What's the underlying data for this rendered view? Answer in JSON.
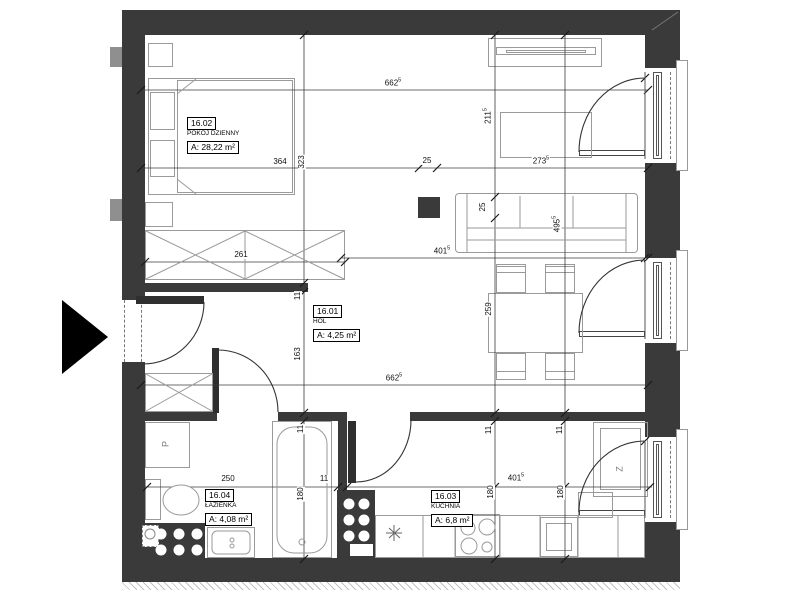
{
  "plan_title": "floor-plan",
  "rooms": [
    {
      "key": "living",
      "id": "16.02",
      "name": "POKÓJ DZIENNY",
      "area": "A: 28,22 m²",
      "x": 187,
      "y": 114
    },
    {
      "key": "hall",
      "id": "16.01",
      "name": "HOL",
      "area": "A: 4,25 m²",
      "x": 313,
      "y": 302
    },
    {
      "key": "bathroom",
      "id": "16.04",
      "name": "ŁAZIENKA",
      "area": "A: 4,08 m²",
      "x": 205,
      "y": 486
    },
    {
      "key": "kitchen",
      "id": "16.03",
      "name": "KUCHNIA",
      "area": "A: 6,8 m²",
      "x": 431,
      "y": 487
    }
  ],
  "dimensions": [
    {
      "v": "662",
      "sup": "5",
      "x": 393,
      "y": 83,
      "o": "h"
    },
    {
      "v": "364",
      "sup": "",
      "x": 280,
      "y": 162,
      "o": "h"
    },
    {
      "v": "25",
      "sup": "",
      "x": 427,
      "y": 161,
      "o": "h"
    },
    {
      "v": "273",
      "sup": "5",
      "x": 541,
      "y": 161,
      "o": "h"
    },
    {
      "v": "261",
      "sup": "",
      "x": 241,
      "y": 255,
      "o": "h"
    },
    {
      "v": "401",
      "sup": "5",
      "x": 442,
      "y": 251,
      "o": "h"
    },
    {
      "v": "662",
      "sup": "5",
      "x": 394,
      "y": 378,
      "o": "h"
    },
    {
      "v": "250",
      "sup": "",
      "x": 228,
      "y": 479,
      "o": "h"
    },
    {
      "v": "11",
      "sup": "",
      "x": 324,
      "y": 479,
      "o": "h"
    },
    {
      "v": "401",
      "sup": "5",
      "x": 516,
      "y": 478,
      "o": "h"
    },
    {
      "v": "323",
      "sup": "",
      "x": 302,
      "y": 162,
      "o": "v"
    },
    {
      "v": "211",
      "sup": "5",
      "x": 488,
      "y": 116,
      "o": "v"
    },
    {
      "v": "25",
      "sup": "",
      "x": 483,
      "y": 207,
      "o": "v"
    },
    {
      "v": "259",
      "sup": "",
      "x": 489,
      "y": 309,
      "o": "v"
    },
    {
      "v": "11",
      "sup": "",
      "x": 489,
      "y": 430,
      "o": "v"
    },
    {
      "v": "180",
      "sup": "",
      "x": 491,
      "y": 492,
      "o": "v"
    },
    {
      "v": "495",
      "sup": "5",
      "x": 557,
      "y": 224,
      "o": "v"
    },
    {
      "v": "11",
      "sup": "",
      "x": 560,
      "y": 430,
      "o": "v"
    },
    {
      "v": "180",
      "sup": "",
      "x": 561,
      "y": 492,
      "o": "v"
    },
    {
      "v": "11",
      "sup": "",
      "x": 298,
      "y": 296,
      "o": "v"
    },
    {
      "v": "163",
      "sup": "",
      "x": 298,
      "y": 354,
      "o": "v"
    },
    {
      "v": "11",
      "sup": "",
      "x": 301,
      "y": 429,
      "o": "v"
    },
    {
      "v": "180",
      "sup": "",
      "x": 301,
      "y": 494,
      "o": "v"
    }
  ],
  "appliance_labels": [
    {
      "v": "P",
      "x": 166,
      "y": 444
    },
    {
      "v": "Z",
      "x": 620,
      "y": 469
    }
  ],
  "colors": {
    "wall": "#3a3a3a",
    "furniture_line": "#9a9a9a",
    "dimension_line": "#3c3c3c",
    "entry_arrow": "#000000"
  }
}
